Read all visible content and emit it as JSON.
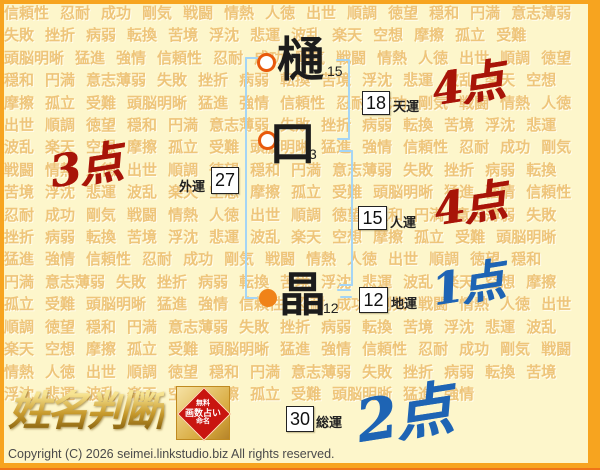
{
  "background": {
    "words": [
      "信頼性",
      "忍耐",
      "成功",
      "剛気",
      "戦闘",
      "情熱",
      "人徳",
      "出世",
      "順調",
      "徳望",
      "穏和",
      "円満",
      "意志薄弱",
      "失敗",
      "挫折",
      "病弱",
      "転換",
      "苦境",
      "浮沈",
      "悲運",
      "波乱",
      "楽天",
      "空想",
      "摩擦",
      "孤立",
      "受難",
      "頭脳明晰",
      "猛進",
      "強情"
    ],
    "repeat": 8
  },
  "name_chars": [
    {
      "char": "樋",
      "strokes": "15"
    },
    {
      "char": "口",
      "strokes": "3"
    },
    {
      "char": "晶",
      "strokes": "12"
    }
  ],
  "fortunes": {
    "heaven": {
      "label": "天運",
      "value": "18",
      "score": "4点"
    },
    "outer": {
      "label": "外運",
      "value": "27",
      "score": "3点"
    },
    "person": {
      "label": "人運",
      "value": "15",
      "score": "4点"
    },
    "earth": {
      "label": "地運",
      "value": "12",
      "score": "1点"
    },
    "total": {
      "label": "総運",
      "value": "30",
      "score": "2点"
    }
  },
  "colors": {
    "red": "#a81408",
    "blue": "#1e64b4",
    "frame_orange": "#f7a41f",
    "bracket_blue": "#a5d5f5",
    "marker_orange": "#f08318"
  },
  "logo": {
    "title": "姓名判断",
    "seal_line1": "無料",
    "seal_line2": "画数占い",
    "seal_line3": "命名"
  },
  "footer": {
    "copyright": "Copyright (C) 2026 seimei.linkstudio.biz All rights reserved."
  }
}
